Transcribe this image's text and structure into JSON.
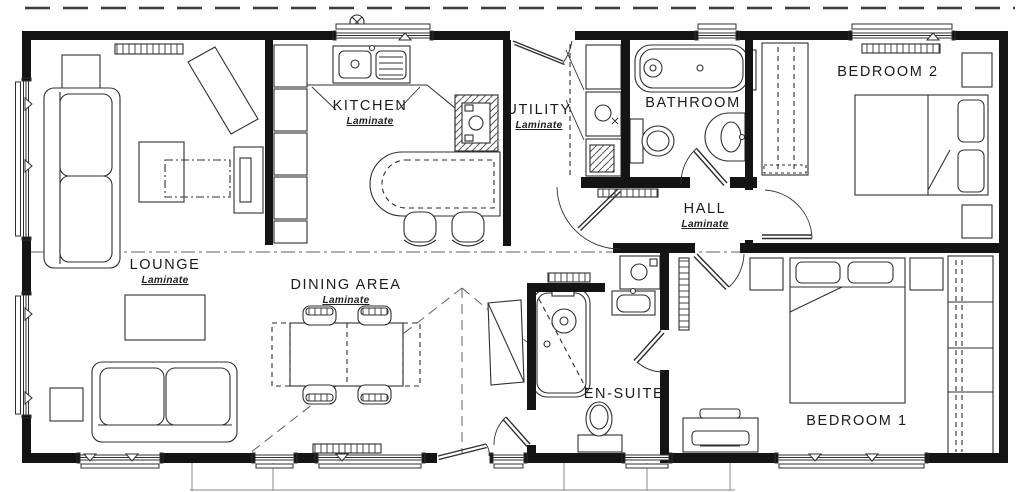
{
  "title": "Two bedroom lodge floor plan",
  "rooms": [
    {
      "name": "LOUNGE",
      "flooring": "Laminate"
    },
    {
      "name": "KITCHEN",
      "flooring": "Laminate"
    },
    {
      "name": "DINING AREA",
      "flooring": "Laminate"
    },
    {
      "name": "UTILITY",
      "flooring": "Laminate"
    },
    {
      "name": "BATHROOM",
      "flooring": ""
    },
    {
      "name": "HALL",
      "flooring": "Laminate"
    },
    {
      "name": "EN-SUITE",
      "flooring": ""
    },
    {
      "name": "BEDROOM 2",
      "flooring": ""
    },
    {
      "name": "BEDROOM 1",
      "flooring": ""
    }
  ],
  "fixtures": [
    "sofa",
    "coffee-table",
    "tv-unit",
    "console-table",
    "side-table",
    "dining-table",
    "dining-chairs",
    "sideboard",
    "breakfast-bar",
    "bar-stools",
    "kitchen-sink",
    "hob",
    "kitchen-cabinets",
    "washing-machine",
    "tumble-dryer",
    "bath",
    "shower-bath",
    "toilet",
    "wash-basin",
    "towel-rail",
    "boiler-cupboard",
    "double-bed",
    "bedside-table",
    "wardrobe",
    "airing-cupboard",
    "chest-of-drawers",
    "radiator",
    "window",
    "door"
  ],
  "colors": {
    "wall": "#141414",
    "line": "#2f2f2f",
    "background": "#ffffff"
  }
}
